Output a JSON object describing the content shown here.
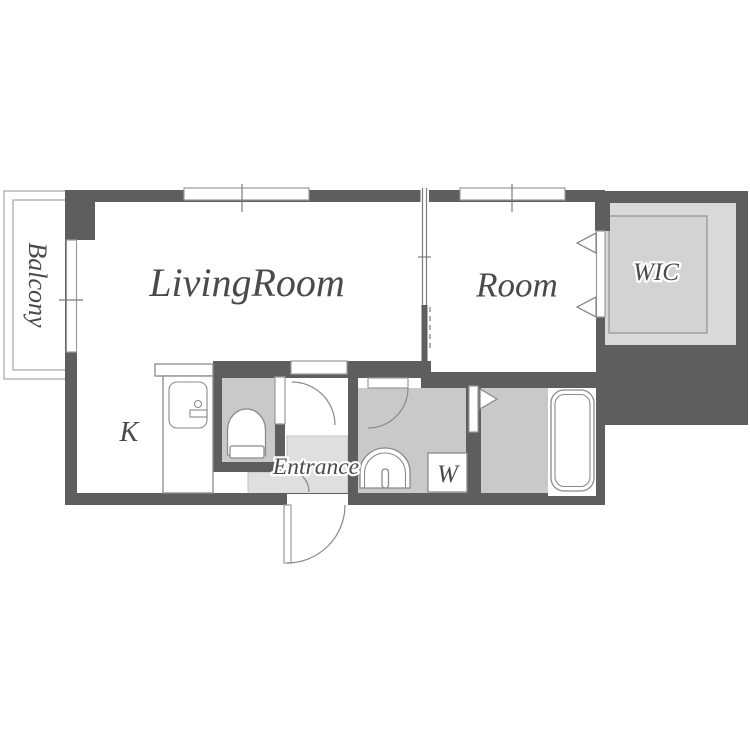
{
  "plan": {
    "type": "apartment-floor-plan",
    "labels": {
      "balcony": "Balcony",
      "living_room": "LivingRoom",
      "room": "Room",
      "wic": "WIC",
      "kitchen": "K",
      "entrance": "Entrance",
      "washer": "W"
    },
    "colors": {
      "background": "#ffffff",
      "wall": "#5e5e5e",
      "wet_floor": "#c9c9c9",
      "entrance_floor": "#dfdfdf",
      "wic_floor": "#d9d9d9",
      "wic_inner_floor": "#d3d3d3",
      "outline": "#8a8a8a",
      "label_text": "#4a4a4a"
    }
  }
}
